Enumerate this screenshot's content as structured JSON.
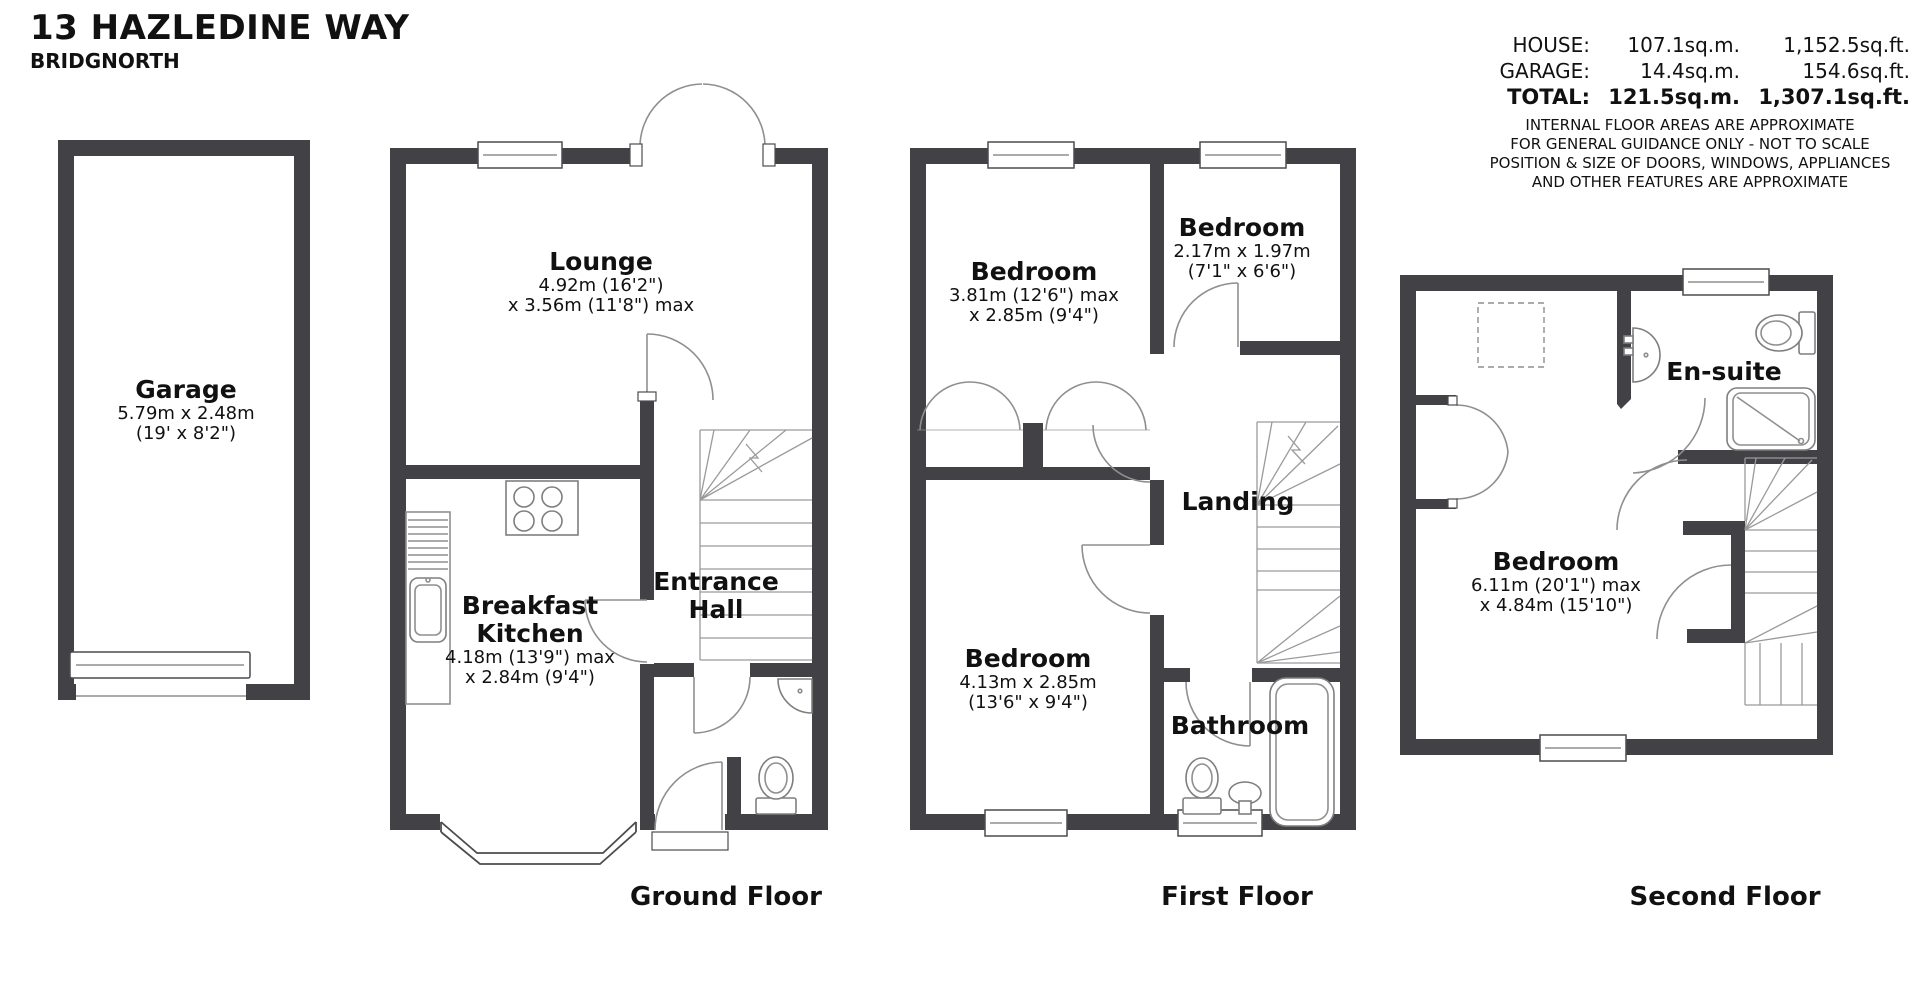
{
  "header": {
    "title": "13 HAZLEDINE WAY",
    "subtitle": "BRIDGNORTH"
  },
  "area_summary": {
    "rows": [
      {
        "label": "HOUSE:",
        "sqm": "107.1sq.m.",
        "sqft": "1,152.5sq.ft."
      },
      {
        "label": "GARAGE:",
        "sqm": "14.4sq.m.",
        "sqft": "154.6sq.ft."
      },
      {
        "label": "TOTAL:",
        "sqm": "121.5sq.m.",
        "sqft": "1,307.1sq.ft."
      }
    ],
    "disclaimer": [
      "INTERNAL FLOOR AREAS ARE APPROXIMATE",
      "FOR GENERAL GUIDANCE ONLY - NOT TO SCALE",
      "POSITION & SIZE OF DOORS, WINDOWS, APPLIANCES",
      "AND OTHER FEATURES ARE APPROXIMATE"
    ]
  },
  "floors": {
    "ground": "Ground Floor",
    "first": "First Floor",
    "second": "Second Floor"
  },
  "rooms": {
    "garage": {
      "name": "Garage",
      "dim1": "5.79m x 2.48m",
      "dim2": "(19' x 8'2\")"
    },
    "lounge": {
      "name": "Lounge",
      "dim1": "4.92m (16'2\")",
      "dim2": "x 3.56m (11'8\") max"
    },
    "breakfast_kitchen": {
      "name1": "Breakfast",
      "name2": "Kitchen",
      "dim1": "4.18m (13'9\") max",
      "dim2": "x 2.84m (9'4\")"
    },
    "entrance_hall": {
      "name1": "Entrance",
      "name2": "Hall"
    },
    "bedroom_1": {
      "name": "Bedroom",
      "dim1": "3.81m (12'6\") max",
      "dim2": "x 2.85m (9'4\")"
    },
    "bedroom_2": {
      "name": "Bedroom",
      "dim1": "2.17m x 1.97m",
      "dim2": "(7'1\" x 6'6\")"
    },
    "bedroom_3": {
      "name": "Bedroom",
      "dim1": "4.13m x 2.85m",
      "dim2": "(13'6\" x 9'4\")"
    },
    "landing": {
      "name": "Landing"
    },
    "bathroom": {
      "name": "Bathroom"
    },
    "ensuite": {
      "name": "En-suite"
    },
    "bedroom_4": {
      "name": "Bedroom",
      "dim1": "6.11m (20'1\") max",
      "dim2": "x 4.84m (15'10\")"
    }
  },
  "colors": {
    "wall": "#424246",
    "line": "#8f8f8f",
    "text": "#111111"
  }
}
